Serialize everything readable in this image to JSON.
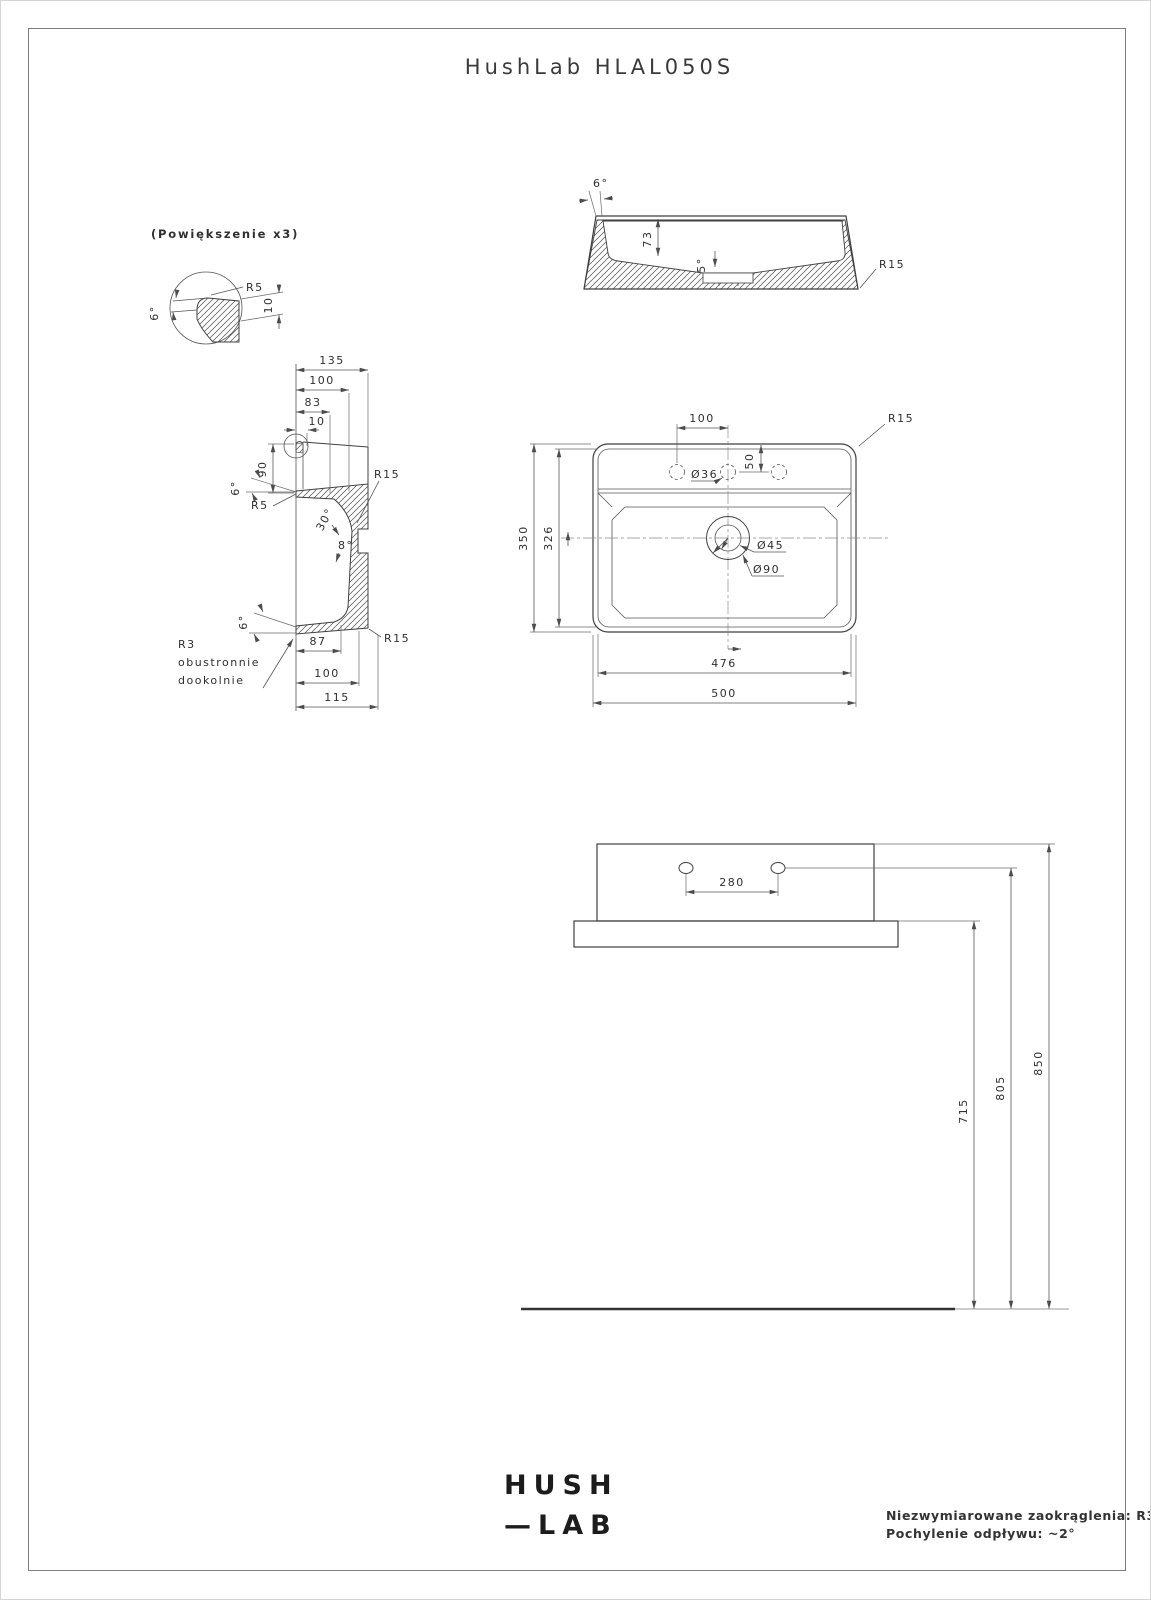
{
  "header": {
    "title": "HushLab HLAL050S"
  },
  "detail_view": {
    "caption": "(Powiększenie x3)",
    "r5": "R5",
    "angle6": "6°",
    "dim10": "10"
  },
  "side_view": {
    "angle6": "6°",
    "dim73": "73",
    "angle5": "5°",
    "r15": "R15"
  },
  "section_view": {
    "dim135": "135",
    "dim100_top": "100",
    "dim83": "83",
    "dim10": "10",
    "dim90": "90",
    "angle6_top": "6°",
    "r5": "R5",
    "r15_top": "R15",
    "angle30": "30°",
    "angle8": "8°",
    "angle6_bottom": "6°",
    "note_line1": "R3",
    "note_line2": "obustronnie",
    "note_line3": "dookolnie",
    "dim87": "87",
    "dim100_bottom": "100",
    "dim115": "115",
    "r15_bottom": "R15"
  },
  "top_view": {
    "dim100": "100",
    "dim50": "50",
    "dia36": "Ø36",
    "r15": "R15",
    "dia45": "Ø45",
    "dia90": "Ø90",
    "dim350": "350",
    "dim326": "326",
    "dim476": "476",
    "dim500": "500"
  },
  "front_view": {
    "dim280": "280",
    "dim715": "715",
    "dim805": "805",
    "dim850": "850"
  },
  "footer": {
    "logo_line1": "HUSH",
    "logo_line2": "—LAB",
    "note_line1": "Niezwymiarowane zaokrąglenia: R3",
    "note_line2": "Pochylenie odpływu: ~2°"
  }
}
